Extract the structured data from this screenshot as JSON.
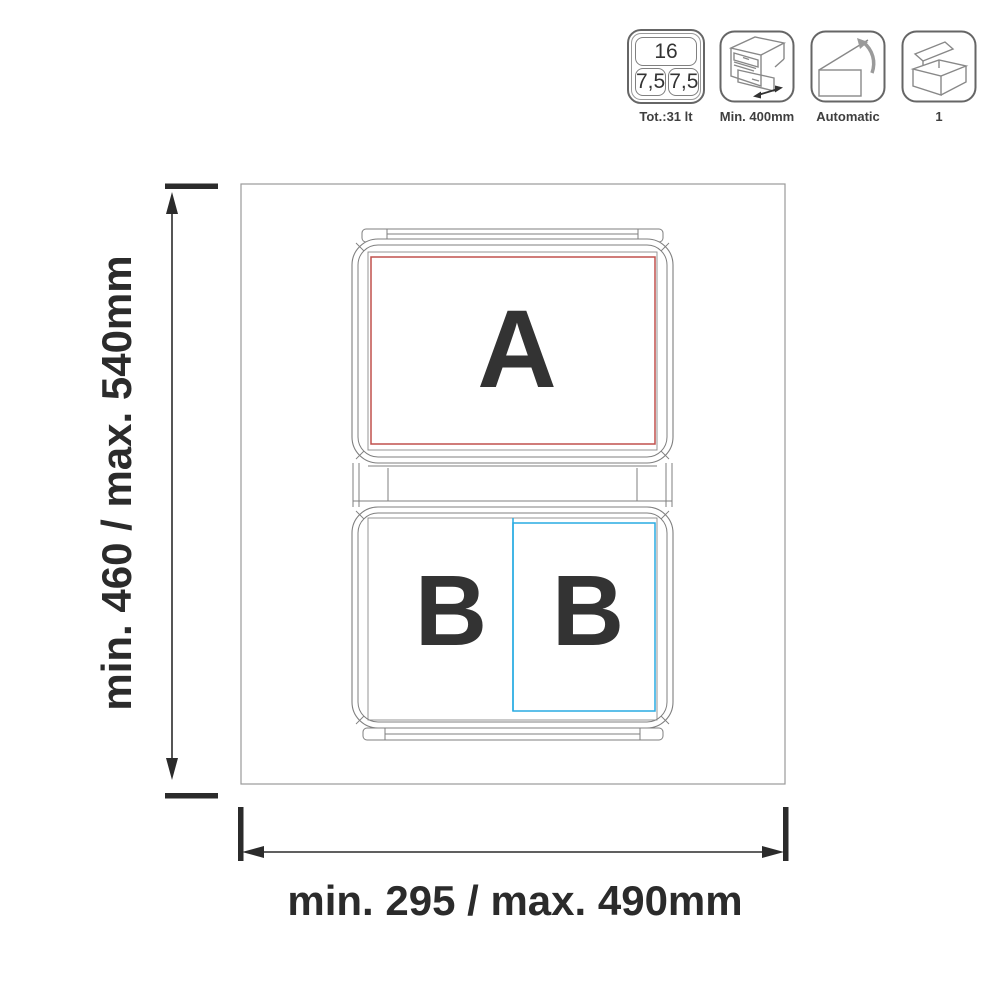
{
  "header_icons": {
    "capacity": {
      "top_value": "16",
      "left_value": "7,5",
      "right_value": "7,5",
      "label": "Tot.:31 lt"
    },
    "cabinet": {
      "label": "Min. 400mm"
    },
    "automatic": {
      "label": "Automatic"
    },
    "package": {
      "label": "1"
    }
  },
  "diagram": {
    "bin_a": "A",
    "bin_b_left": "B",
    "bin_b_right": "B",
    "height_dim": "min. 460 / max. 540mm",
    "width_dim": "min. 295 / max. 490mm"
  },
  "colors": {
    "red_zone": "#C0504D",
    "blue_zone": "#29ABE2",
    "line_gray": "#7f7f7f",
    "dimension_dark": "#2b2b2b"
  }
}
